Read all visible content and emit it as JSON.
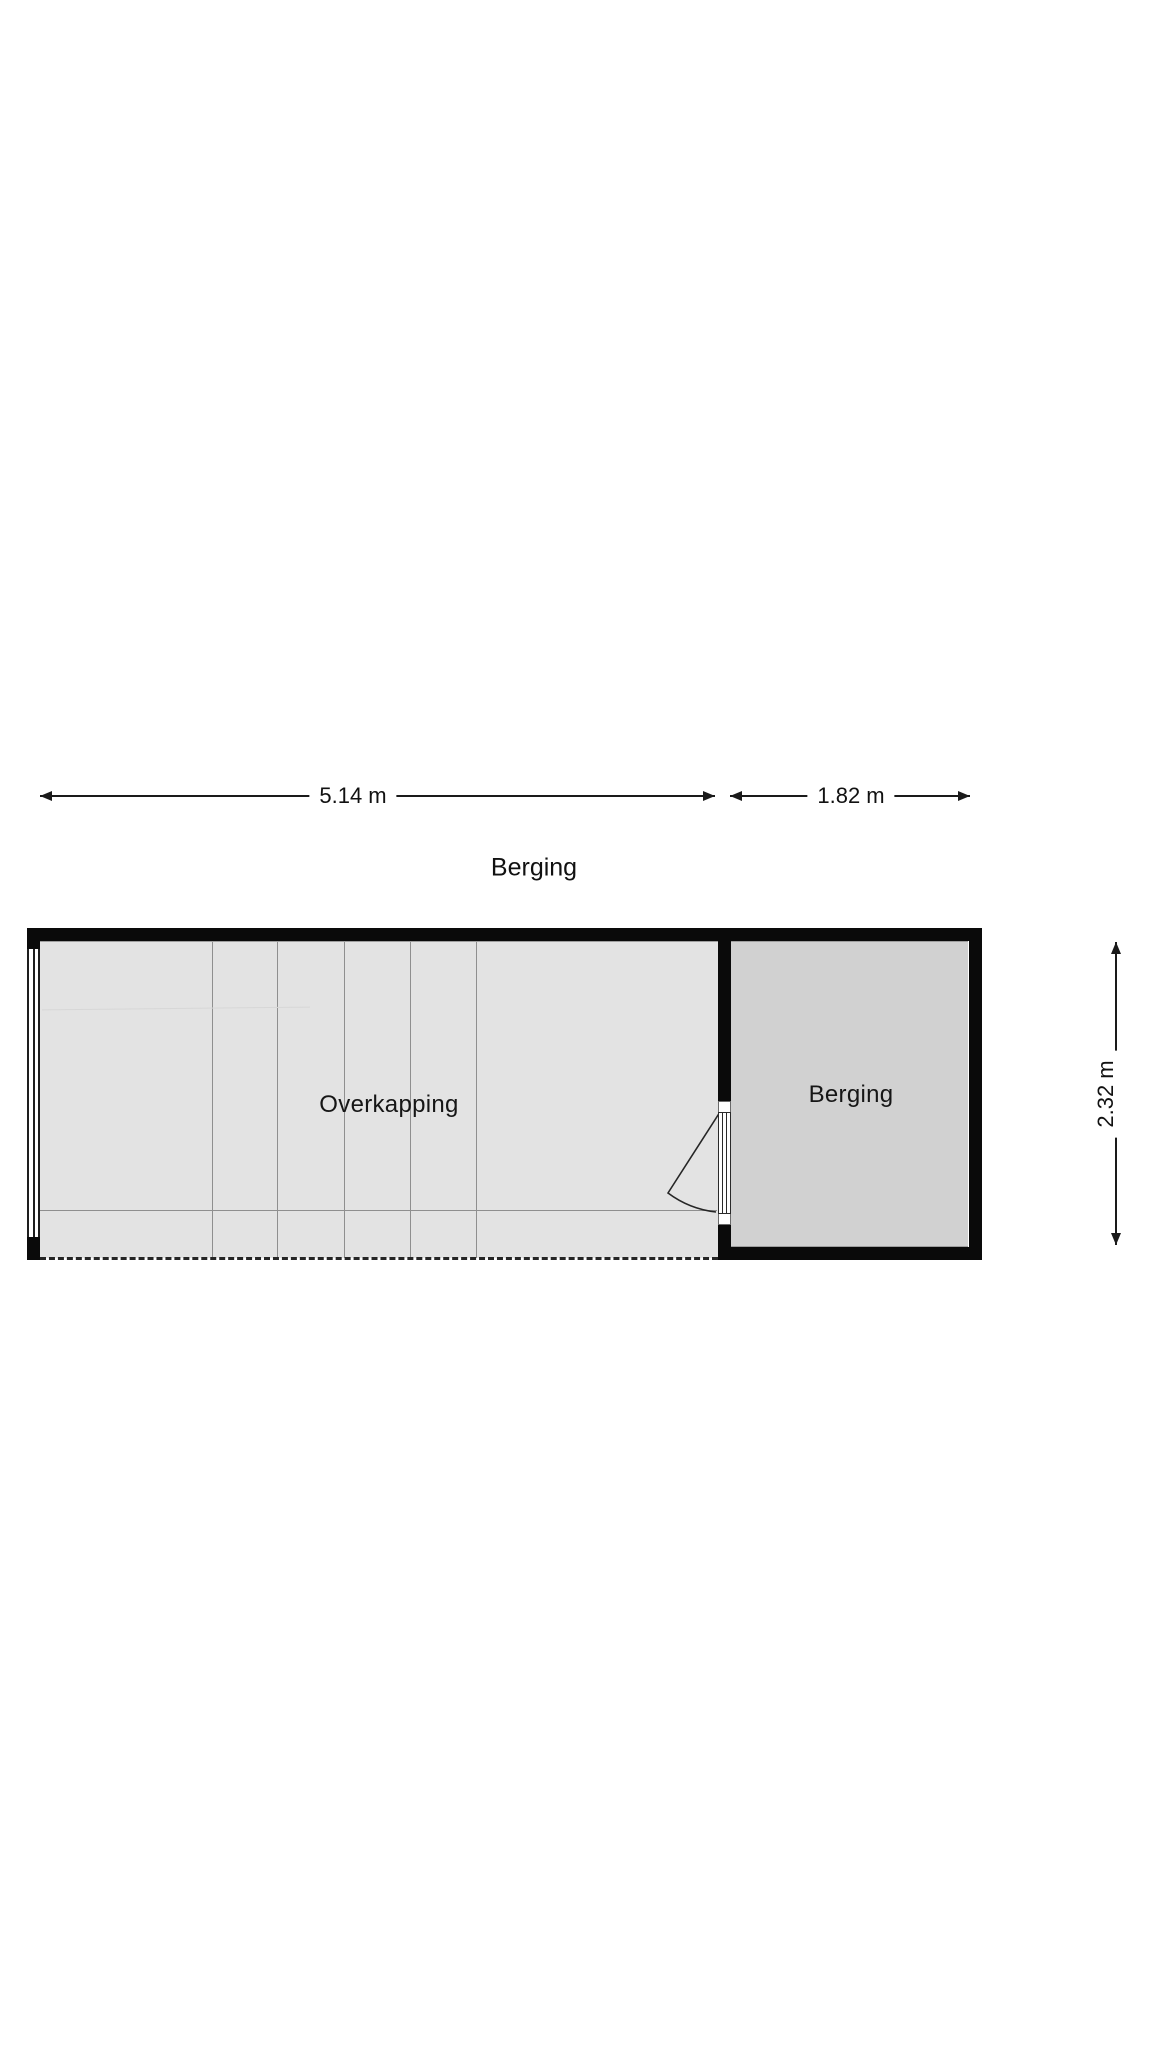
{
  "title": "Berging",
  "dimensions": {
    "overkapping_width": {
      "label": "5.14 m"
    },
    "berging_width": {
      "label": "1.82 m"
    },
    "plan_depth": {
      "label": "2.32 m"
    }
  },
  "rooms": {
    "overkapping": {
      "label": "Overkapping"
    },
    "berging": {
      "label": "Berging"
    }
  },
  "colors": {
    "wall": "#0a0a0a",
    "overkapping-fill": "#e3e3e3",
    "berging-fill": "#d1d1d1",
    "thin-line": "#8f8f8f",
    "dim-line": "#1a1a1a",
    "text": "#111111",
    "page-bg": "#ffffff"
  }
}
